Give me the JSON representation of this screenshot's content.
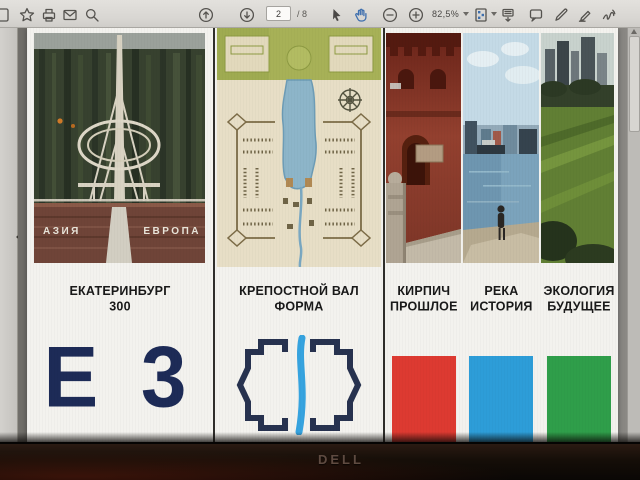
{
  "toolbar": {
    "page_current": "2",
    "page_separator": "/ 8",
    "zoom_level": "82,5%",
    "icons": [
      "save",
      "star",
      "print",
      "email",
      "search",
      "page-up",
      "page-down",
      "select-cursor",
      "hand-tool",
      "zoom-out",
      "zoom-in",
      "page-view-mode",
      "scrolling-mode",
      "comment",
      "draw",
      "highlight",
      "sign"
    ]
  },
  "slide": {
    "panel1": {
      "title": "ЕКАТЕРИНБУРГ",
      "subtitle": "300",
      "logo": "Е 3",
      "photo": {
        "left_label": "АЗИЯ",
        "right_label": "ЕВРОПА"
      }
    },
    "panel2": {
      "title": "КРЕПОСТНОЙ ВАЛ",
      "subtitle": "ФОРМА"
    },
    "panel3": {
      "columns": [
        {
          "title": "КИРПИЧ",
          "subtitle": "ПРОШЛОЕ",
          "swatch_color": "#dd3a31"
        },
        {
          "title": "РЕКА",
          "subtitle": "ИСТОРИЯ",
          "swatch_color": "#2d9dd8"
        },
        {
          "title": "ЭКОЛОГИЯ",
          "subtitle": "БУДУЩЕЕ",
          "swatch_color": "#2f9e4a"
        }
      ]
    }
  },
  "monitor": {
    "brand": "DELL"
  },
  "colors": {
    "logo_navy": "#1d2b57",
    "fort_icon_navy": "#27324f",
    "river_blue": "#36a3df",
    "toolbar_selected": "#3e6fae"
  }
}
